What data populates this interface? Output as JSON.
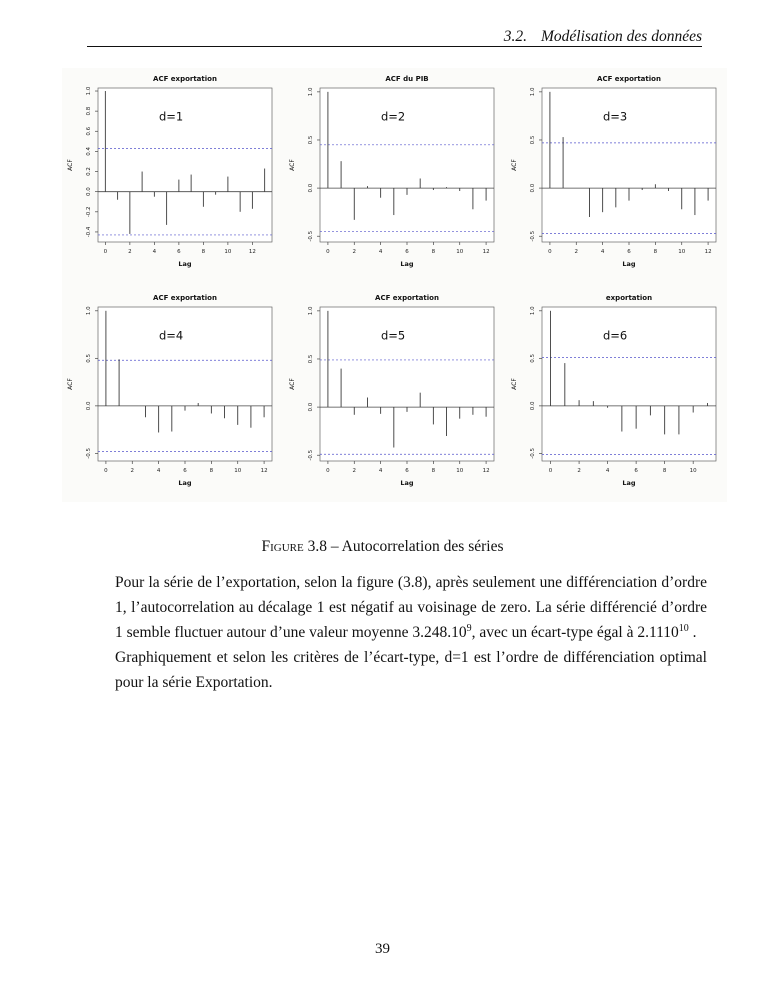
{
  "header": {
    "section_number": "3.2.",
    "section_title": "Modélisation des données"
  },
  "caption": {
    "prefix": "Figure",
    "rest": " 3.8 – Autocorrelation des séries"
  },
  "body": {
    "p1_part1": "Pour la série de l’exportation, selon la figure (3.8), après seulement une différenciation d’ordre 1, l’autocorrelation au décalage 1 est négatif au voisinage de zero. La série différencié d’ordre 1 semble fluctuer autour d’une valeur moyenne 3.248.10",
    "p1_sup1": "9",
    "p1_part2": ", avec un écart-type égal à 2.1110",
    "p1_sup2": "10",
    "p1_part3": " .",
    "p2": "Graphiquement et selon les critères de l’écart-type, d=1 est l’ordre de différenciation optimal pour la série Exportation."
  },
  "footer": {
    "page_number": "39"
  },
  "colors": {
    "conf_line": "#5555cc",
    "stem": "#3a3a3a",
    "axis": "#444444",
    "box": "#666666",
    "figure_bg": "#fbfbf9"
  },
  "chart_data": [
    {
      "type": "bar",
      "subtype": "acf-stem",
      "title": "ACF exportation",
      "annotation": "d=1",
      "xlabel": "Lag",
      "ylabel": "ACF",
      "x": [
        0,
        1,
        2,
        3,
        4,
        5,
        6,
        7,
        8,
        9,
        10,
        11,
        12,
        13
      ],
      "values": [
        1.0,
        -0.08,
        -0.42,
        0.2,
        -0.05,
        -0.33,
        0.12,
        0.17,
        -0.15,
        -0.03,
        0.15,
        -0.2,
        -0.17,
        0.23
      ],
      "yticks": [
        1.0,
        0.8,
        0.6,
        0.4,
        0.2,
        0.0,
        -0.2,
        -0.4
      ],
      "xticks": [
        0,
        2,
        4,
        6,
        8,
        10,
        12
      ],
      "conf": 0.43,
      "ylim": [
        -0.5,
        1.03
      ],
      "grid": false,
      "legend": "none"
    },
    {
      "type": "bar",
      "subtype": "acf-stem",
      "title": "ACF du PIB",
      "annotation": "d=2",
      "xlabel": "Lag",
      "ylabel": "ACF",
      "x": [
        0,
        1,
        2,
        3,
        4,
        5,
        6,
        7,
        8,
        9,
        10,
        11,
        12
      ],
      "values": [
        1.0,
        0.28,
        -0.33,
        0.02,
        -0.1,
        -0.28,
        -0.07,
        0.1,
        -0.02,
        0.01,
        -0.03,
        -0.22,
        -0.13
      ],
      "yticks": [
        1.0,
        0.5,
        0.0,
        -0.5
      ],
      "xticks": [
        0,
        2,
        4,
        6,
        8,
        10,
        12
      ],
      "conf": 0.45,
      "ylim": [
        -0.56,
        1.04
      ],
      "grid": false,
      "legend": "none"
    },
    {
      "type": "bar",
      "subtype": "acf-stem",
      "title": "ACF exportation",
      "annotation": "d=3",
      "xlabel": "Lag",
      "ylabel": "ACF",
      "x": [
        0,
        1,
        2,
        3,
        4,
        5,
        6,
        7,
        8,
        9,
        10,
        11,
        12
      ],
      "values": [
        1.0,
        0.53,
        0.0,
        -0.3,
        -0.25,
        -0.2,
        -0.13,
        -0.02,
        0.04,
        -0.03,
        -0.22,
        -0.28,
        -0.13
      ],
      "yticks": [
        1.0,
        0.5,
        0.0,
        -0.5
      ],
      "xticks": [
        0,
        2,
        4,
        6,
        8,
        10,
        12
      ],
      "conf": 0.47,
      "ylim": [
        -0.56,
        1.04
      ],
      "grid": false,
      "legend": "none"
    },
    {
      "type": "bar",
      "subtype": "acf-stem",
      "title": "ACF exportation",
      "annotation": "d=4",
      "xlabel": "Lag",
      "ylabel": "ACF",
      "x": [
        0,
        1,
        2,
        3,
        4,
        5,
        6,
        7,
        8,
        9,
        10,
        11,
        12
      ],
      "values": [
        1.0,
        0.49,
        0.0,
        -0.12,
        -0.28,
        -0.27,
        -0.05,
        0.03,
        -0.08,
        -0.13,
        -0.2,
        -0.23,
        -0.12
      ],
      "yticks": [
        1.0,
        0.5,
        0.0,
        -0.5
      ],
      "xticks": [
        0,
        2,
        4,
        6,
        8,
        10,
        12
      ],
      "conf": 0.48,
      "ylim": [
        -0.58,
        1.04
      ],
      "grid": false,
      "legend": "none"
    },
    {
      "type": "bar",
      "subtype": "acf-stem",
      "title": "ACF exportation",
      "annotation": "d=5",
      "xlabel": "Lag",
      "ylabel": "ACF",
      "x": [
        0,
        1,
        2,
        3,
        4,
        5,
        6,
        7,
        8,
        9,
        10,
        11,
        12
      ],
      "values": [
        1.0,
        0.4,
        -0.08,
        0.1,
        -0.07,
        -0.42,
        -0.05,
        0.15,
        -0.18,
        -0.3,
        -0.12,
        -0.08,
        -0.1
      ],
      "yticks": [
        1.0,
        0.5,
        0.0,
        -0.5
      ],
      "xticks": [
        0,
        2,
        4,
        6,
        8,
        10,
        12
      ],
      "conf": 0.49,
      "ylim": [
        -0.56,
        1.04
      ],
      "grid": false,
      "legend": "none"
    },
    {
      "type": "bar",
      "subtype": "acf-stem",
      "title": "exportation",
      "annotation": "d=6",
      "xlabel": "Lag",
      "ylabel": "ACF",
      "x": [
        0,
        1,
        2,
        3,
        4,
        5,
        6,
        7,
        8,
        9,
        10,
        11
      ],
      "values": [
        1.0,
        0.45,
        0.06,
        0.05,
        -0.02,
        -0.27,
        -0.24,
        -0.1,
        -0.3,
        -0.3,
        -0.07,
        0.03
      ],
      "yticks": [
        1.0,
        0.5,
        0.0,
        -0.5
      ],
      "xticks": [
        0,
        2,
        4,
        6,
        8,
        10
      ],
      "conf": 0.51,
      "ylim": [
        -0.58,
        1.04
      ],
      "grid": false,
      "legend": "none"
    }
  ]
}
